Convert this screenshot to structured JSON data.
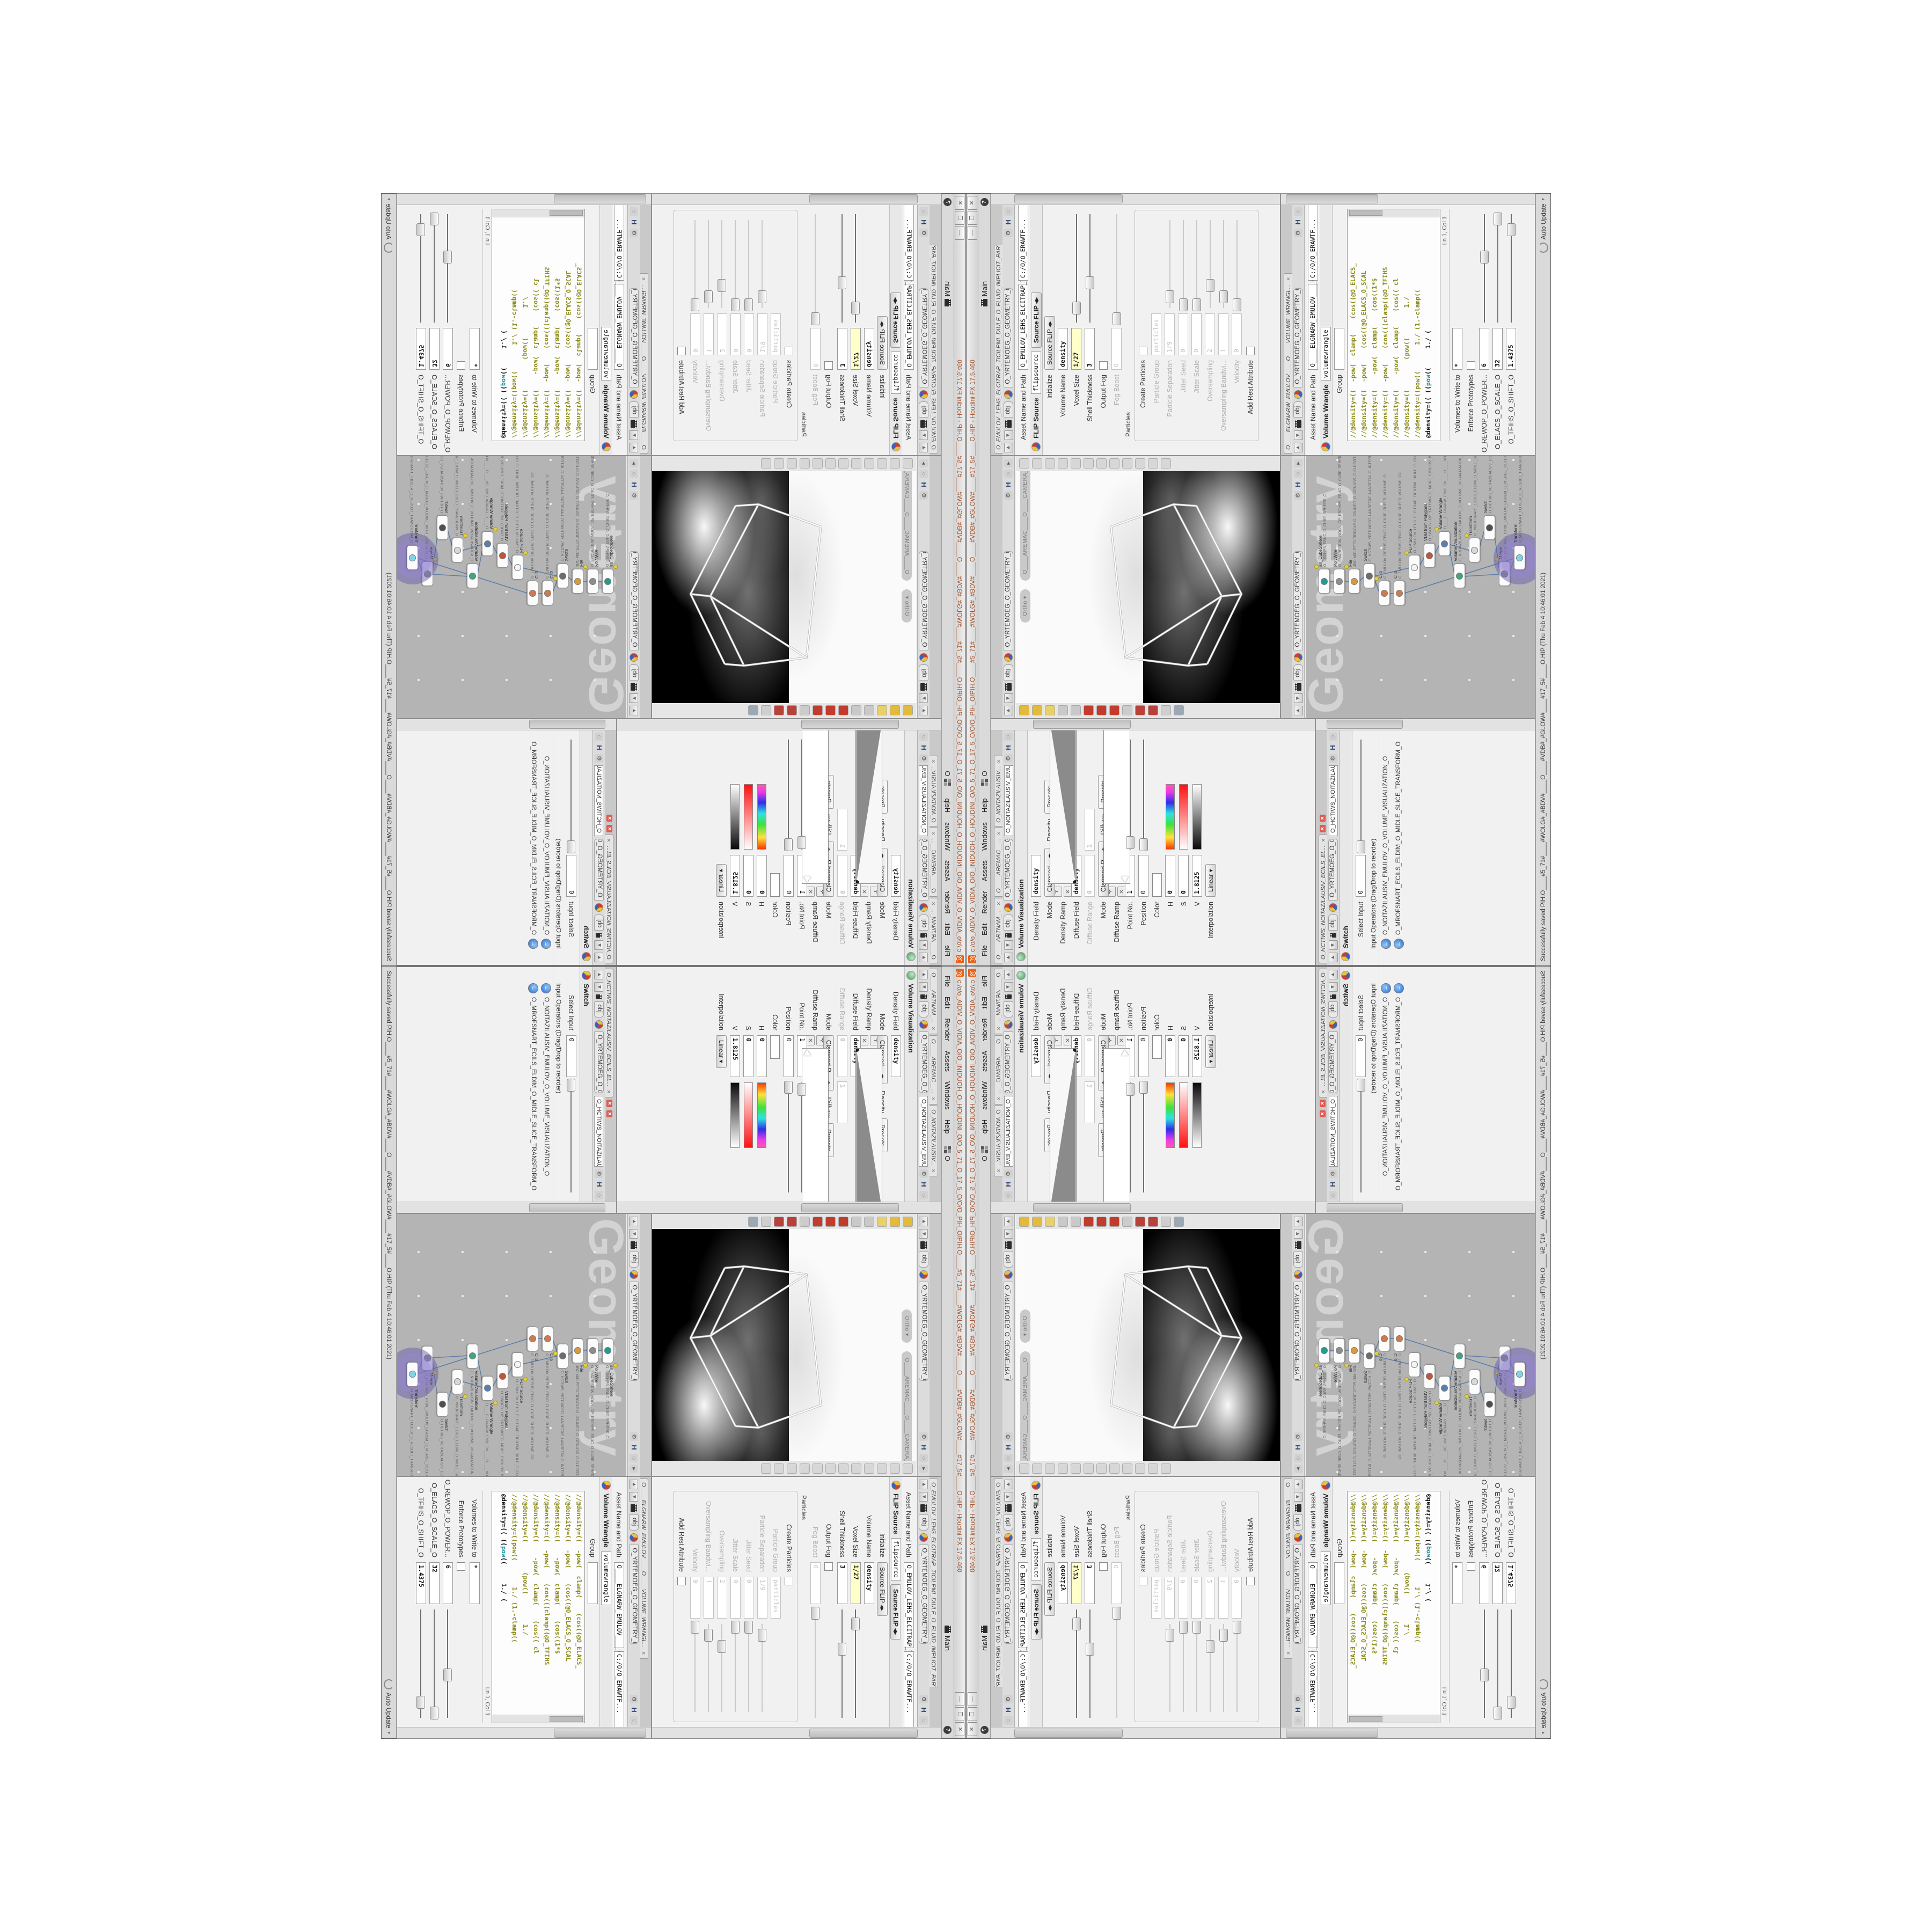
{
  "window": {
    "title": "c:/o/o_AIDIV_O_VIDIA_O/O_INIDUOH_O_HOUDINI_O/O_5_71_O_17_5_O/O/O_PIH_O/PIH.O____#5_71#____#WOLG#_#BDV#____O____#VDB#_#GLOW#____#17_5#____O.HIP - Houdini FX 17.5.460",
    "app_icon": "houdini-spiral-icon",
    "buttons": {
      "minimize": "—",
      "maximize": "❐",
      "close": "✕"
    }
  },
  "menu": {
    "items": [
      "File",
      "Edit",
      "Render",
      "Assets",
      "Windows",
      "Help"
    ],
    "desktop_item": "O",
    "desktop_name": "Main",
    "help_badge": "?"
  },
  "path": {
    "root": "obj",
    "node": "O_YRTEMOEG_O_GEOMETRY_O"
  },
  "panes": {
    "volume_visualization": {
      "tabs": [
        "O____ARTNAM_...",
        "O____AREMAC__...",
        "O_NOITAZILAUSIV..."
      ],
      "path_value": "O_NOITAZILAUSIV_EMULO",
      "header": "Volume Visualization",
      "params": [
        {
          "label": "Density Field",
          "type": "field",
          "value": "density",
          "bold": true
        },
        {
          "label": "Mode",
          "type": "mode",
          "value": "Clamped...",
          "section": "Density",
          "button": "Presets"
        },
        {
          "label": "Density Ramp",
          "type": "ramp_density"
        },
        {
          "label": "Diffuse Field",
          "type": "field",
          "value": "density",
          "bold": true
        },
        {
          "label": "Diffuse Range",
          "type": "range",
          "value": "0",
          "value2": "1",
          "disabled": true
        },
        {
          "label": "Mode",
          "type": "mode",
          "value": "Clamped R...",
          "section": "Diffuse",
          "button": "Presets"
        },
        {
          "label": "Diffuse Ramp",
          "type": "ramp_diffuse"
        },
        {
          "label": "Point No.",
          "type": "field",
          "value": "1",
          "slider": 0.06
        },
        {
          "label": "Position",
          "type": "field",
          "value": "0",
          "slider": 0.04
        },
        {
          "label": "Color",
          "type": "color"
        },
        {
          "label": "H",
          "type": "hsv",
          "value": "0",
          "gradient": "hue"
        },
        {
          "label": "S",
          "type": "hsv",
          "value": "0",
          "gradient": "sat"
        },
        {
          "label": "V",
          "type": "hsv",
          "value": "1.8125",
          "gradient": "val"
        },
        {
          "label": "Interpolation",
          "type": "drop",
          "value": "Linear"
        }
      ]
    },
    "slice_switch": {
      "tabs": [
        "O_HCTIWS_NOITAZILAUSIV_ECILS_EL..."
      ],
      "path_value": "O_HCTIWS_NOITAZILAUSIV_ECILS_EL",
      "header": "Switch",
      "params": [
        {
          "label": "Select Input",
          "type": "field",
          "value": "0",
          "slider": 0.02
        },
        {
          "type": "labelrow",
          "value": "Input Operators (Drag/Drop to reorder)"
        },
        {
          "type": "inputop",
          "value": "O_NOITAZILAUSIV_EMULOV_O_VOLUME_VISUALIZATION_O"
        },
        {
          "type": "inputop",
          "value": "O_MROFSNART_ECILS_ELDIM_O_MIDLE_SLICE_TRANSFORM_O"
        }
      ]
    },
    "viewport": {
      "camera_pill": "O____AREMAC____O____CAMERA____O",
      "ortho_pill": "Ortho",
      "left_tool_icons": [
        "select-tool-icon",
        "lasso-tool-icon",
        "paint-tool-icon",
        "view-tool-icon",
        "move-tool-icon",
        "rotate-tool-icon",
        "scale-tool-icon",
        "pose-tool-icon",
        "axis-tool-icon",
        "snap-magnet-icon",
        "snap-multi-icon",
        "render-region-icon",
        "film-reel-icon"
      ],
      "right_tool_icons": [
        "persp-icon",
        "camera-icon",
        "pin-icon",
        "grid-icon",
        "shade-icon",
        "wire-icon",
        "points-icon",
        "normals-icon",
        "lights-icon",
        "fog-icon",
        "background-icon",
        "snapshot-icon"
      ]
    },
    "network": {
      "watermark": "Geometry",
      "nodes": [
        {
          "type": "an_CubeSphere",
          "name": "O_EREHPS_EBUC_O_CUBE_SPHERE_O",
          "color": "#1f9e8e"
        },
        {
          "type": "PolyWire",
          "name": "O_EMARFERIW_NOGYLOP_EREHPS_EBUC_O_CUBE_SPHERE_POLYGON_WIREFRAME_O",
          "color": "#8d8d8d"
        },
        {
          "type": "File",
          "name": "JBO.M01.PETS.TIRGOLS.O_SSUNEG_O_GENUSS_O.SLDGRT.STEP.M01.OBJ",
          "color": "#d89b3c"
        },
        {
          "type": "Switch",
          "name": "O_HCTIWS_YRTEMOEG_LANRETXE_LANRETNI_O_INTERNAL_EXTERNAL_GEOMETRY_SWITCH_O",
          "color": "#6d6d6d"
        },
        {
          "type": "Clip",
          "name": "O_EMULOV_REPUS_EBUC_O_CUBE_SUPER_VOLUME_O",
          "color": "#cf7a4e"
        },
        {
          "type": "Clip",
          "name": "O_EMULOV_REPUS_EBUC_O_CUBE_SUPER_VOLUME_O2",
          "color": "#cf7a4e"
        },
        {
          "type": "FLIP Source",
          "name": "O_EMULOV_LEHS_ELCITRAP_TICILPMI_DIULF_O_FLUID_IMPLICIT_PARTICLE_SHEL_VOLUME_O",
          "color": "#f4f4f4"
        },
        {
          "type": "VDB from Polygons",
          "name": "O_SNOGYLOP_YRTEMOEG_MORF_EMULOV_BDV_O_VDB_VOLUME_FROM_GEOMETRY_POLYGONS_O",
          "color": "#c2543e"
        },
        {
          "type": "Volume Wrangle",
          "name": "O____ELGNARW_EMULOV____O____VOLUME_WRANGLE____O2",
          "color": "#5a7fae"
        },
        {
          "type": "Volume Visualization",
          "name": "O_NOITAZILAUSIV_EMULOV_O_VOLUME_VISUALIZATION_O",
          "color": "#43a47f"
        },
        {
          "type": "Transform",
          "name": "O_MROFSNART_ECILS_ELDIM_O_MIDLE_SLICE_TRANSFORM_O",
          "color": "#d8d8d8"
        },
        {
          "type": "Switch",
          "name": "O_HCTIWS_NOITAZILAUSIV_ECILS_ELDIM_O_MIDLE_SLICE_VISUALIZATION_SWITCH_O",
          "color": "#4f4f4f"
        },
        {
          "type": "Merge",
          "name": "O_ECAFRUS_HTIW_EMULOV_EGREM_O_MERGE_VOLUME_WITH_SURFACE_O",
          "color": "#9a9a9a"
        },
        {
          "type": "Transform",
          "name": "O_MROFSNART_TLUSER_O_RESULT_TRANSFORM_O",
          "color": "#7fd4e8",
          "selected": true
        }
      ]
    },
    "flip_source": {
      "tabs": [
        "O_EMULOV_LEHS_ELCITRAP_TICILPMI_DIULF_O_FLUID_IMPLICIT_PARTI..."
      ],
      "header": "FLIP Source",
      "node_name": "flipsource",
      "preset": "Source FLIP",
      "params": [
        {
          "label": "Asset Name and Path",
          "type": "twofield",
          "value": "O_EMULOV_LEHS_ELCITRAP_TICI",
          "value2": "C:/O/O_ERAWTF..."
        },
        {
          "label": "Initialize",
          "type": "drop2",
          "value": "Source FLIP"
        },
        {
          "label": "Volume Name",
          "type": "field",
          "value": "density",
          "bold": true
        },
        {
          "label": "Voxel Size",
          "type": "yfield",
          "value": "1/27",
          "slider": 0.13
        },
        {
          "label": "Shell Thickness",
          "type": "field",
          "value": "3",
          "bold": true,
          "slider": 0.36
        },
        {
          "label": "Output Fog",
          "type": "check"
        },
        {
          "label": "Fog Boost",
          "type": "field",
          "value": "0",
          "disabled": true,
          "slider": 0.03
        },
        {
          "type": "group",
          "value": "Particles"
        },
        {
          "label": "Create Particles",
          "type": "check",
          "ingroup": true
        },
        {
          "label": "Particle Group",
          "type": "field",
          "value": "particles",
          "disabled": true,
          "ingroup": true
        },
        {
          "label": "Particle Separation",
          "type": "field",
          "value": "1/9",
          "disabled": true,
          "ingroup": true,
          "slider": 0.12
        },
        {
          "label": "Jitter Seed",
          "type": "field",
          "value": "0",
          "disabled": true,
          "ingroup": true,
          "slider": 0.03
        },
        {
          "label": "Jitter Scale",
          "type": "field",
          "value": "0",
          "disabled": true,
          "ingroup": true,
          "slider": 0.03
        },
        {
          "label": "Oversampling",
          "type": "field",
          "value": "2",
          "disabled": true,
          "ingroup": true,
          "slider": 0.25
        },
        {
          "label": "Oversampling Bandwi...",
          "type": "field",
          "value": "1",
          "disabled": true,
          "ingroup": true,
          "slider": 0.12
        },
        {
          "label": "Velocity",
          "type": "field",
          "value": "0",
          "disabled": true,
          "ingroup": true,
          "slider": 0.03
        },
        {
          "label": "Add Rest Attribute",
          "type": "check",
          "ingroup": true
        }
      ]
    },
    "volume_wrangle": {
      "tabs": [
        "O____ELGNARW_EMULOV____O____VOLUME_WRANGL..."
      ],
      "header": "Volume Wrangle",
      "node_name": "volumewrangle",
      "code_lines": [
        "//@density=((  -pow(  clamp(    (cos((@O_ELACS_",
        "//@density=((  -pow(    (cos((@O_ELACS_O_SCAL",
        "//@density=((    -pow(  clamp(    (cos((1*$",
        "//@density=((  -pow(    (cos(((clamp((@O_TFIHS",
        "//@density=((    -pow(  clamp(    (cos(( cl",
        "//@density=((        (pow((        1./",
        "//@density=((pow((       1./ (1.-clamp((",
        "@density=(( ((pow((     1./ ("
      ],
      "cursor_status": "Ln 1, Col 1",
      "params": [
        {
          "label": "Asset Name and Path",
          "type": "twofield",
          "value": "O____ELGNARW_EMULOV____O",
          "value2": "C:/O/O_ERAWTF..."
        },
        {
          "label": "Group",
          "type": "field",
          "value": ""
        },
        {
          "type": "code"
        },
        {
          "type": "lncol",
          "value": "Ln 1, Col 1"
        },
        {
          "label": "Volumes to Write to",
          "type": "field",
          "value": "*",
          "bold": true
        },
        {
          "label": "Enforce Prototypes",
          "type": "check"
        },
        {
          "label": "O_REWOP_O_POWER...",
          "type": "field",
          "value": "6",
          "bold": true,
          "slider": 0.6
        },
        {
          "label": "O_ELACS_O_SCALE_O",
          "type": "field",
          "value": "32",
          "bold": true,
          "slider": 0.95
        },
        {
          "label": "O_TFIHS_O_SHIFT_O",
          "type": "field",
          "value": "1.4375",
          "bold": true,
          "slider": 0.85
        }
      ]
    }
  },
  "status_bar": {
    "message": "Successfully saved PIH.O____#5_71#____#WOLG#_#BDV#____O____#VDB#_#GLOW#____#17_5#____O.HIP (Thu Feb  4 10:46:01 2021)",
    "auto_update": "Auto Update"
  },
  "colors": {
    "chrome": "#d6d6d6",
    "network_bg": "#b4b4b4",
    "wire": "#5d7fa8",
    "selection_halo": "#806ec8",
    "keyframed_field": "#ffffc9",
    "title_text": "#a4542e",
    "houdini_logo": "#e8641b"
  }
}
